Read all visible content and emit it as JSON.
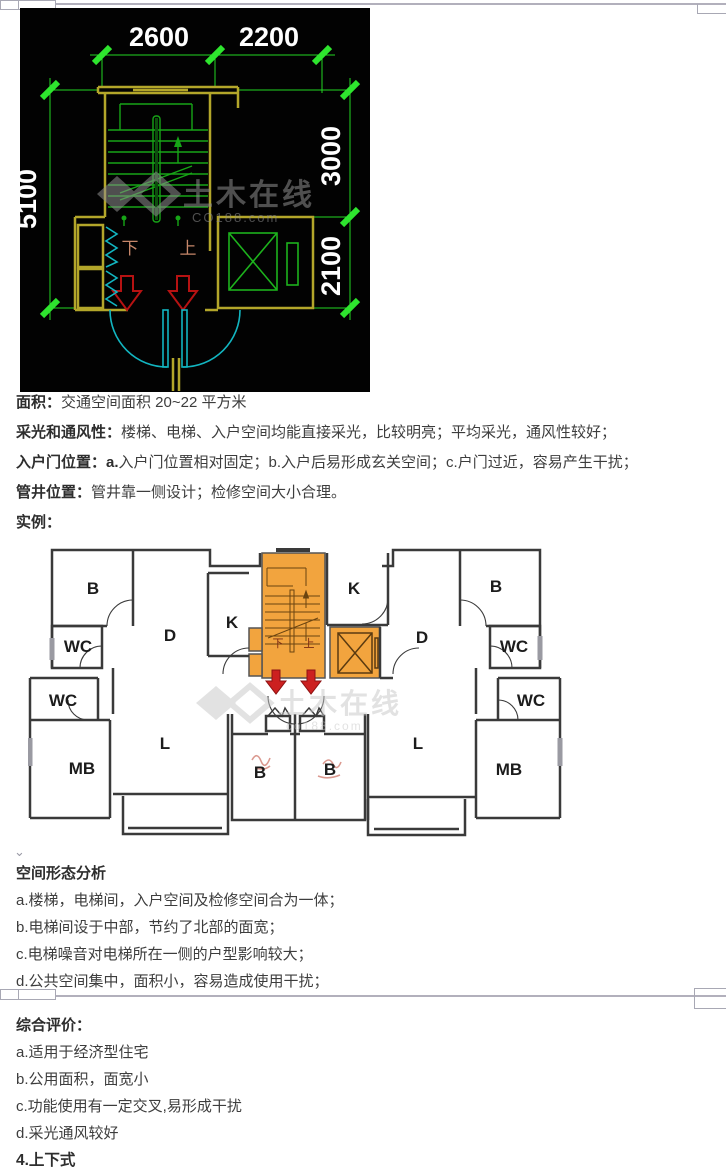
{
  "page": {
    "bg": "#ffffff"
  },
  "colors": {
    "accent_orange": "#f2a43e",
    "cad_wall_yellow": "#b3a62a",
    "cad_dim_green": "#23d523",
    "cad_stair_green": "#17a517",
    "cad_door_cyan": "#12b5c0",
    "cad_arrow_red": "#b61212",
    "plan_wall": "#3a3a3a",
    "plan_arrow_red": "#cc2020"
  },
  "cad": {
    "dims": {
      "top": [
        "2600",
        "2200"
      ],
      "left": "5100",
      "right": [
        "3000",
        "2100"
      ]
    },
    "stair_labels": {
      "down": "下",
      "up": "上"
    },
    "watermark": {
      "line1": "土木在线",
      "line2": "CO188.com"
    }
  },
  "sections": {
    "area": {
      "label": "面积：",
      "text": "交通空间面积 20~22 平方米"
    },
    "lighting": {
      "label": "采光和通风性：",
      "text": "楼梯、电梯、入户空间均能直接采光，比较明亮；平均采光，通风性较好；"
    },
    "entry": {
      "label": "入户门位置：",
      "bold_a": "a.",
      "text": "入户门位置相对固定；b.入户后易形成玄关空间；c.户门过近，容易产生干扰；"
    },
    "shaft": {
      "label": "管井位置：",
      "text": "管井靠一侧设计；检修空间大小合理。"
    },
    "example": {
      "label": "实例："
    }
  },
  "floorplan": {
    "room_labels": [
      "B",
      "WC",
      "D",
      "K",
      "K",
      "D",
      "B",
      "WC",
      "WC",
      "MB",
      "L",
      "B",
      "B",
      "L",
      "WC",
      "MB"
    ],
    "core_labels": {
      "down": "下",
      "up": "上"
    },
    "watermark": {
      "line1": "土木在线",
      "line2": "co188.com"
    }
  },
  "analysis": {
    "title": "空间形态分析",
    "items": [
      "a.楼梯，电梯间，入户空间及检修空间合为一体；",
      "b.电梯间设于中部，节约了北部的面宽；",
      "c.电梯噪音对电梯所在一侧的户型影响较大；",
      "d.公共空间集中，面积小，容易造成使用干扰；"
    ]
  },
  "evaluation": {
    "title": "综合评价：",
    "items": [
      "a.适用于经济型住宅",
      "b.公用面积，面宽小",
      "c.功能使用有一定交叉,易形成干扰",
      "d.采光通风较好"
    ]
  },
  "next_heading": "4.上下式",
  "marks": {
    "anchor_chevron": "⌄"
  }
}
